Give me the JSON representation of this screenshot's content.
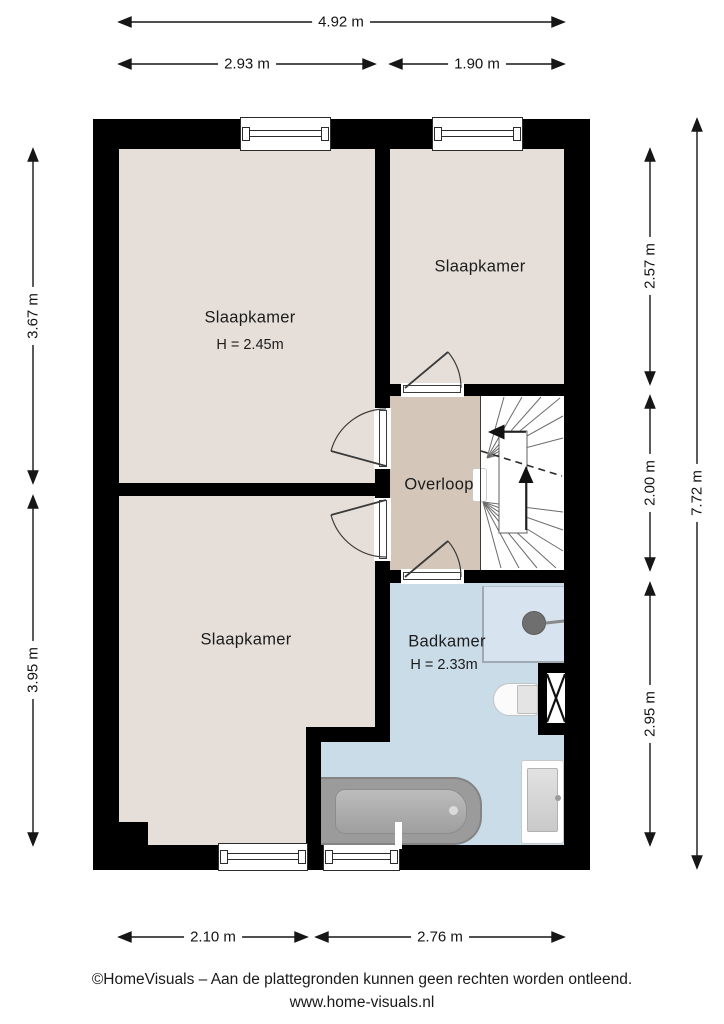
{
  "rooms": [
    {
      "name": "Slaapkamer",
      "height": "H = 2.45m"
    },
    {
      "name": "Slaapkamer"
    },
    {
      "name": "Slaapkamer"
    },
    {
      "name": "Overloop"
    },
    {
      "name": "Badkamer",
      "height": "H = 2.33m"
    }
  ],
  "dimensions": {
    "top": [
      "4.92 m",
      "2.93 m",
      "1.90 m"
    ],
    "bottom": [
      "2.10 m",
      "2.76 m"
    ],
    "left": [
      "3.67 m",
      "3.95 m"
    ],
    "right": [
      "2.57 m",
      "2.00 m",
      "2.95 m"
    ],
    "right_total": "7.72 m"
  },
  "fixtures": [
    "bathtub",
    "toilet",
    "sink",
    "shower",
    "stairs",
    "duct"
  ],
  "colors": {
    "wall": "#000000",
    "bedroom_floor": "#e6dfd9",
    "landing_floor": "#d4c7ba",
    "bathroom_floor": "#cbdce9",
    "fixture_gray": "#9b9b9b"
  },
  "footer": {
    "copyright": "©HomeVisuals – Aan de plattegronden kunnen geen rechten worden ontleend.",
    "website": "www.home-visuals.nl"
  }
}
